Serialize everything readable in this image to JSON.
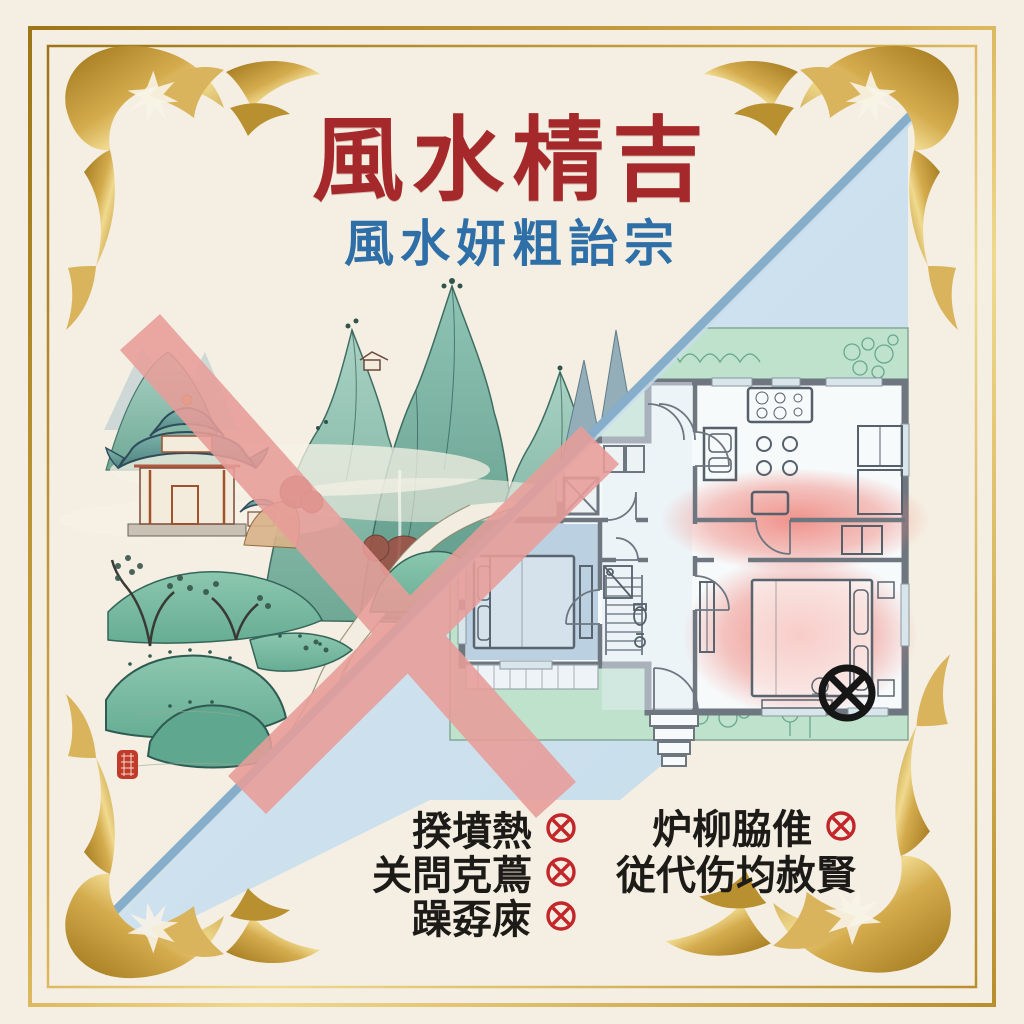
{
  "poster": {
    "background_color": "#F4EFE2",
    "title": {
      "text": "風水棈吉",
      "color": "#A5282A"
    },
    "subtitle": {
      "text": "風水妍粗詒宗",
      "color": "#2E6FA8"
    },
    "border": {
      "gold_color": "#C79A3B",
      "corner_ornaments": [
        "floral-flourish-top-left",
        "floral-flourish-top-right",
        "floral-flourish-bottom-left",
        "dragon-flourish-bottom-right"
      ]
    },
    "artwork": {
      "left_scene": {
        "type": "landscape-painting",
        "rejected_cross_color": "#E89D99",
        "seal_color": "#C23B2A"
      },
      "right_scene": {
        "type": "floor-plan",
        "garden_color": "#BFE2CD",
        "wall_color": "#6E7680",
        "cool_room_color": "#B7CEDF",
        "warm_zone_color": "#F0827C",
        "bad_spot_icon": "crossed-circle-icon",
        "bad_spot_color": "#161616"
      },
      "divider_color": "#86AECB",
      "divider_fill": "#C9DFF0"
    },
    "checklist": {
      "mark_icon": "crossed-circle-icon",
      "mark_color": "#C3262A",
      "left_items": [
        {
          "text": "揆墳熱",
          "marked": true
        },
        {
          "text": "关問克蔦",
          "marked": true
        },
        {
          "text": "躁孬庲",
          "marked": true
        }
      ],
      "right_items": [
        {
          "text": "炉柳脇倠",
          "marked": true
        },
        {
          "text": "従代伤均赦賢",
          "marked": false
        }
      ]
    }
  }
}
